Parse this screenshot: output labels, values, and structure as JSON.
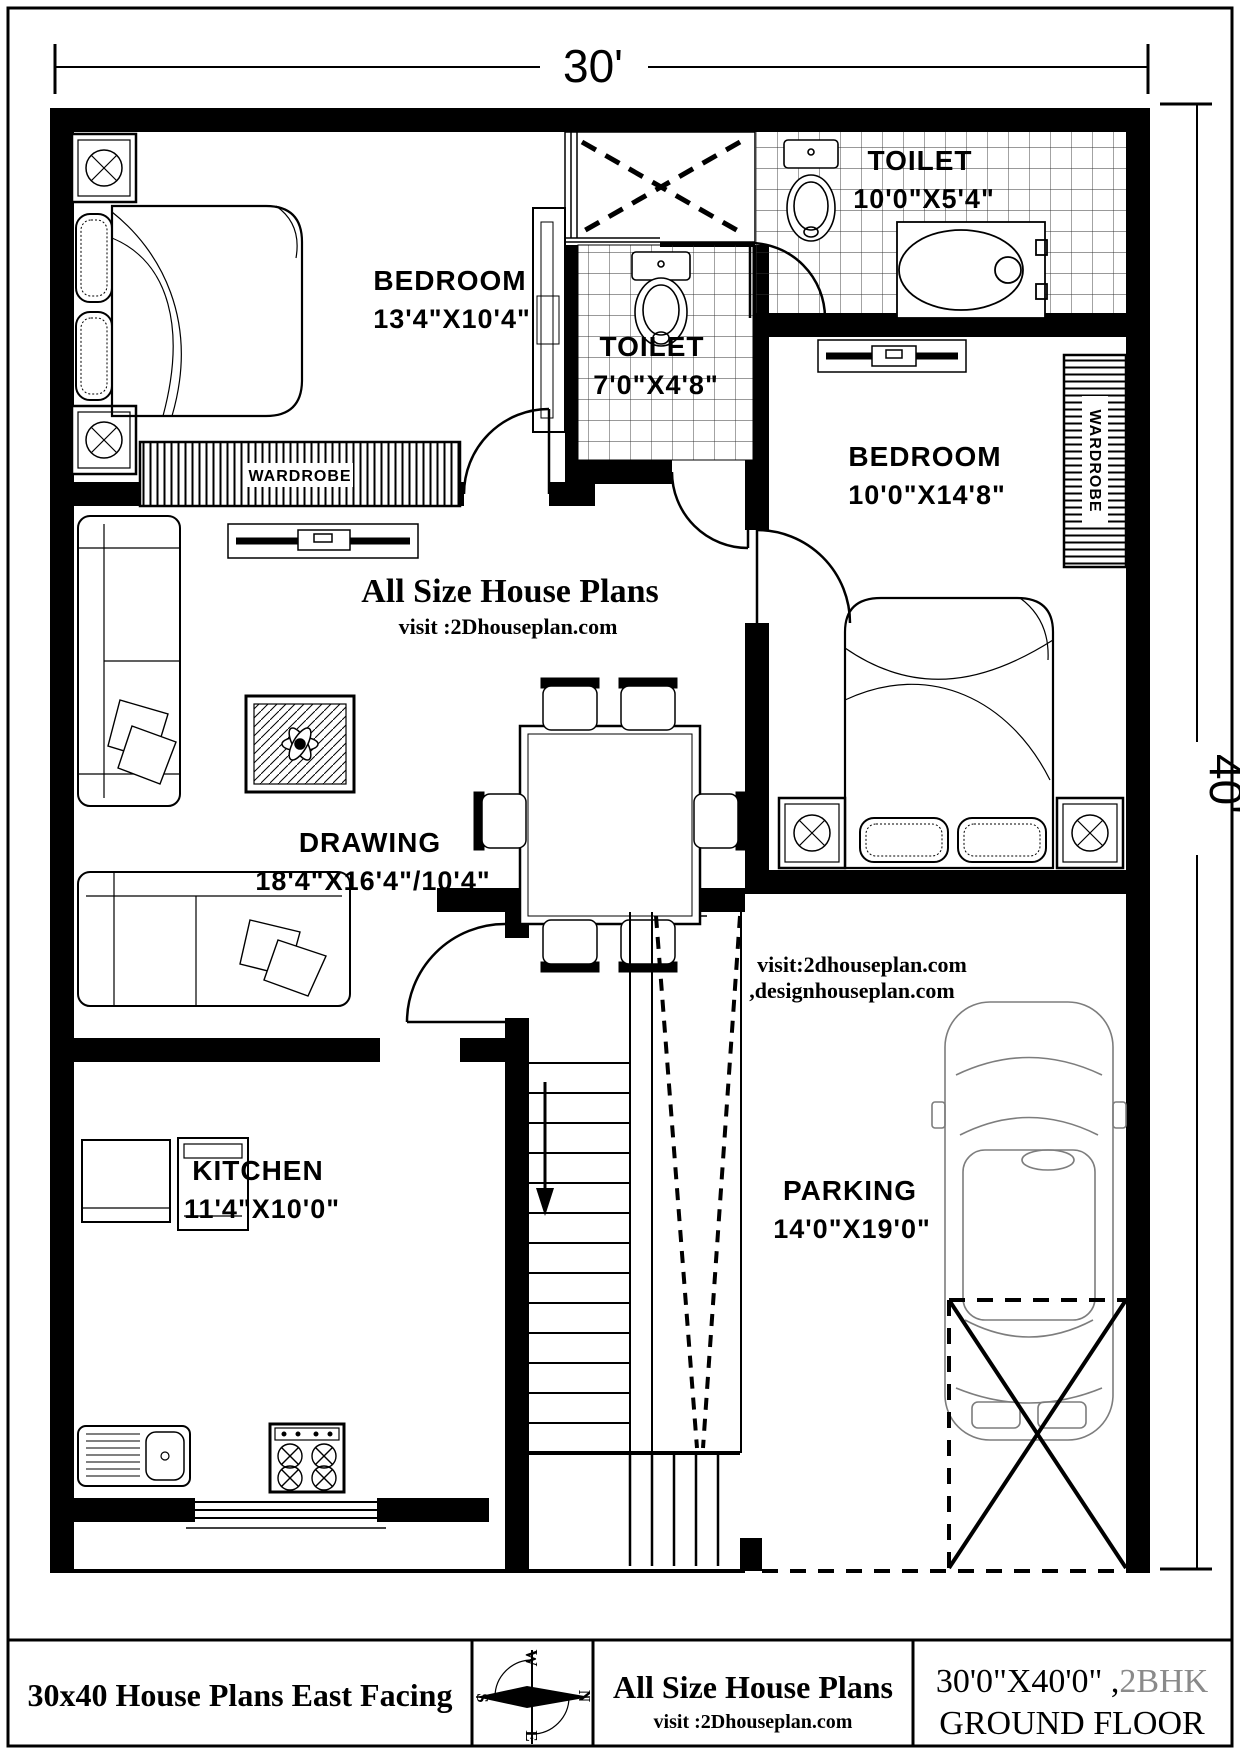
{
  "dimensions": {
    "top": "30'",
    "right": "40'"
  },
  "watermark": {
    "title": "All Size House Plans",
    "subtitle": "visit :2Dhouseplan.com"
  },
  "parking_note": {
    "line1": "visit:2dhouseplan.com",
    "line2": ",designhouseplan.com"
  },
  "rooms": {
    "bedroom1": {
      "name": "BEDROOM",
      "size": "13'4\"X10'4\""
    },
    "toilet1": {
      "name": "TOILET",
      "size": "7'0\"X4'8\""
    },
    "toilet2": {
      "name": "TOILET",
      "size": "10'0\"X5'4\""
    },
    "bedroom2": {
      "name": "BEDROOM",
      "size": "10'0\"X14'8\""
    },
    "drawing": {
      "name": "DRAWING",
      "size": "18'4\"X16'4\"/10'4\""
    },
    "kitchen": {
      "name": "KITCHEN",
      "size": "11'4\"X10'0\""
    },
    "parking": {
      "name": "PARKING",
      "size": "14'0\"X19'0\""
    }
  },
  "fixtures": {
    "wardrobe1": "WARDROBE",
    "wardrobe2": "WARDROBE"
  },
  "compass": {
    "n": "N",
    "s": "S",
    "e": "E",
    "w": "W"
  },
  "title_bar": {
    "caption": "30x40 House Plans East Facing",
    "brand": "All Size House Plans",
    "brand_sub": "visit :2Dhouseplan.com",
    "plot_size": "30'0\"X40'0\" ,",
    "plot_type": "2BHK",
    "floor": "GROUND FLOOR"
  },
  "colors": {
    "accent": "#E2772E",
    "muted": "#8a8a8a",
    "ink": "#000000"
  }
}
